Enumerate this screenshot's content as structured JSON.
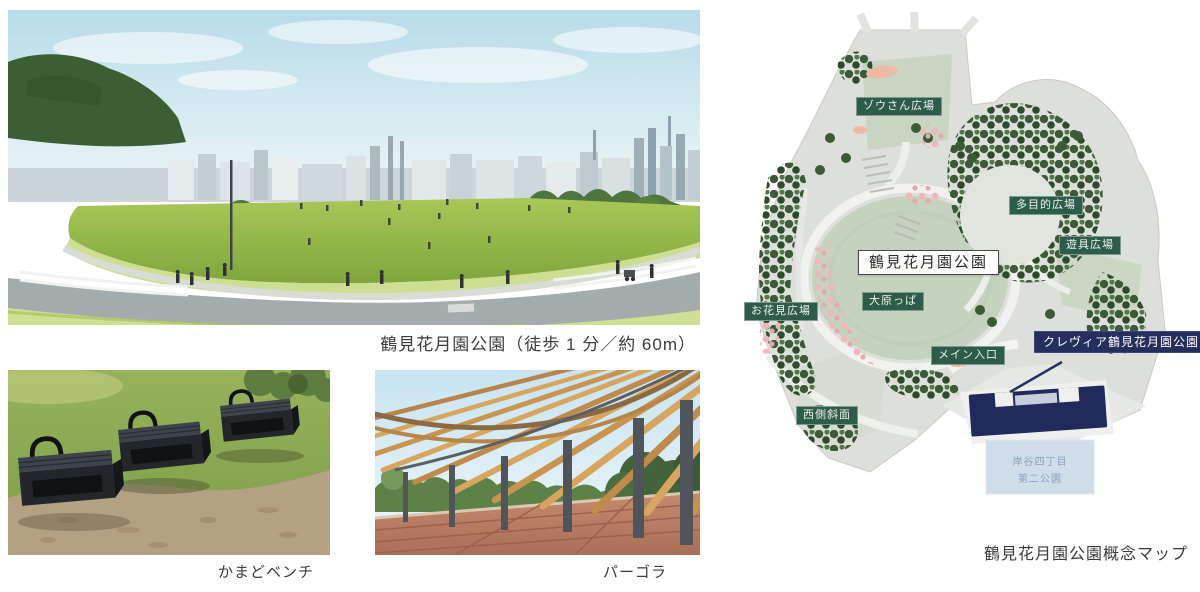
{
  "captions": {
    "main_photo": "鶴見花月園公園（徒歩 1 分／約 60m）",
    "bench_photo": "かまどベンチ",
    "pergola_photo": "パーゴラ",
    "map": "鶴見花月園公園概念マップ"
  },
  "map": {
    "park_name": "鶴見花月園公園",
    "areas": {
      "zou_plaza": "ゾウさん広場",
      "multipurpose_plaza": "多目的広場",
      "playground_plaza": "遊具広場",
      "hanami_plaza": "お花見広場",
      "oharappa": "大原っぱ",
      "main_entrance": "メイン入口",
      "west_slope": "西側斜面"
    },
    "property_name": "クレヴィア鶴見花月園公園",
    "adjacent_park": {
      "line1": "岸谷四丁目",
      "line2": "第二公園"
    },
    "colors": {
      "area_label_green": "#2d5c4a",
      "property_navy": "#242e5f",
      "lawn_green": "#c6d2c0",
      "park_ground": "#dcdfda",
      "tree_dark_green": "#3c5a38",
      "cherry_pink": "#efb6bb",
      "adjacent_park_blue": "#cfdde9"
    }
  }
}
